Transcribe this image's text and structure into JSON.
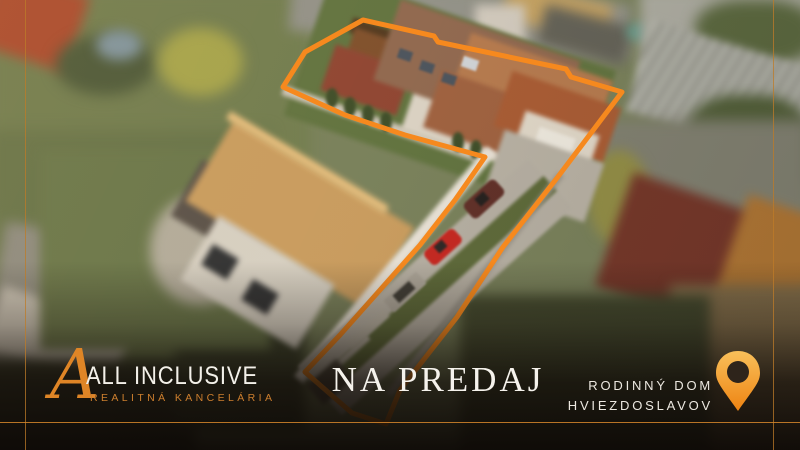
{
  "branding": {
    "monogram": "A",
    "agency_name": "ALL INCLUSIVE",
    "agency_tagline": "REALITNÁ KANCELÁRIA"
  },
  "listing": {
    "status_label": "NA PREDAJ",
    "property_type": "RODINNÝ DOM",
    "location": "HVIEZDOSLAVOV"
  },
  "overlay": {
    "outline_points": "283,87 305,52 363,20 434,36 438,42 566,69 571,77 622,92 557,178 503,247 457,317 400,390 386,424 352,413 305,372 340,335 380,290 420,245 455,200 485,157 405,135 345,115",
    "outline_color": "#F6891E"
  },
  "colors": {
    "accent_orange": "#F6891E",
    "frame_line_orange": "#BE7B28",
    "tagline_orange": "#CD7F2E",
    "text_white": "#F4F1EA"
  },
  "icons": {
    "location_pin": "map-pin",
    "monogram_icon": "letter-A-monogram"
  }
}
